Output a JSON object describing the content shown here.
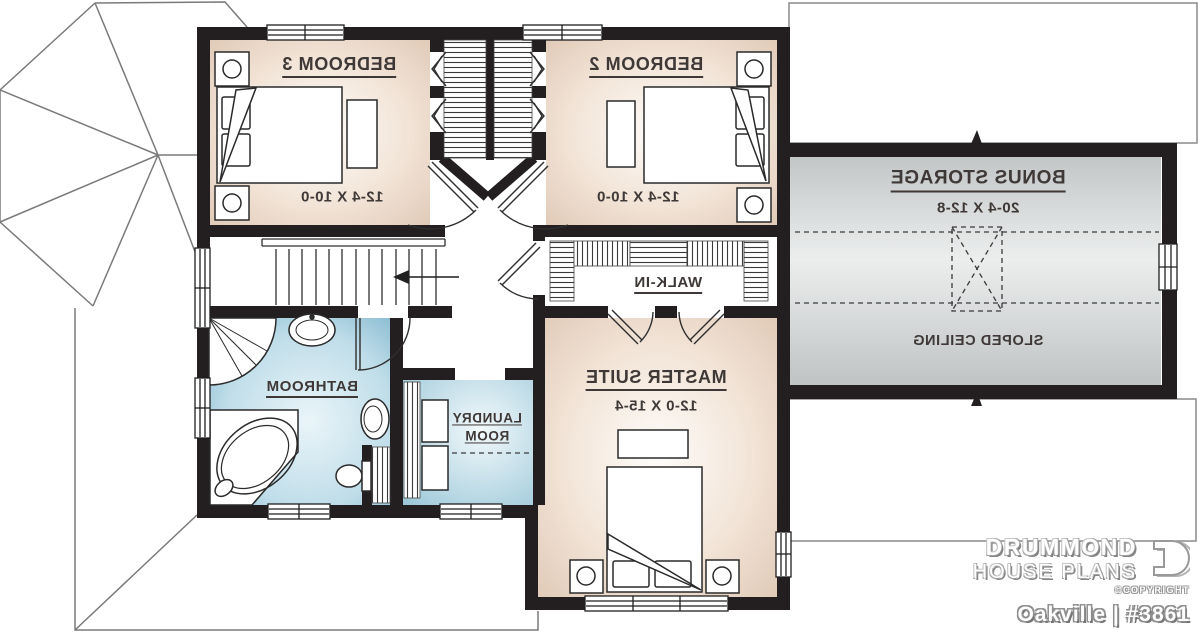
{
  "rooms": {
    "bedroom3": {
      "name": "BEDROOM 3",
      "dims": "12-4 X 10-0"
    },
    "bedroom2": {
      "name": "BEDROOM 2",
      "dims": "12-4 X 10-0"
    },
    "bonus_storage": {
      "name": "BONUS STORAGE",
      "dims": "20-4 X 12-8",
      "note": "SLOPED CEILING"
    },
    "walk_in": {
      "name": "WALK-IN"
    },
    "master_suite": {
      "name": "MASTER SUITE",
      "dims": "12-0 X 15-4"
    },
    "bathroom": {
      "name": "BATHROOM"
    },
    "laundry": {
      "name": "LAUNDRY ROOM"
    }
  },
  "branding": {
    "brand_line1": "DRUMMOND",
    "brand_line2": "HOUSE PLANS",
    "copyright": "©COPYRIGHT",
    "plan_name": "Oakville",
    "divider": "|",
    "plan_number": "#3861"
  },
  "colors": {
    "wall": "#231f20",
    "warm_room": "#e0c9b6",
    "blue_room": "#7fb5cd",
    "bonus_gray": "#c6c9ca",
    "roof_line": "#7a7a7a",
    "label_text": "#3e3836"
  }
}
